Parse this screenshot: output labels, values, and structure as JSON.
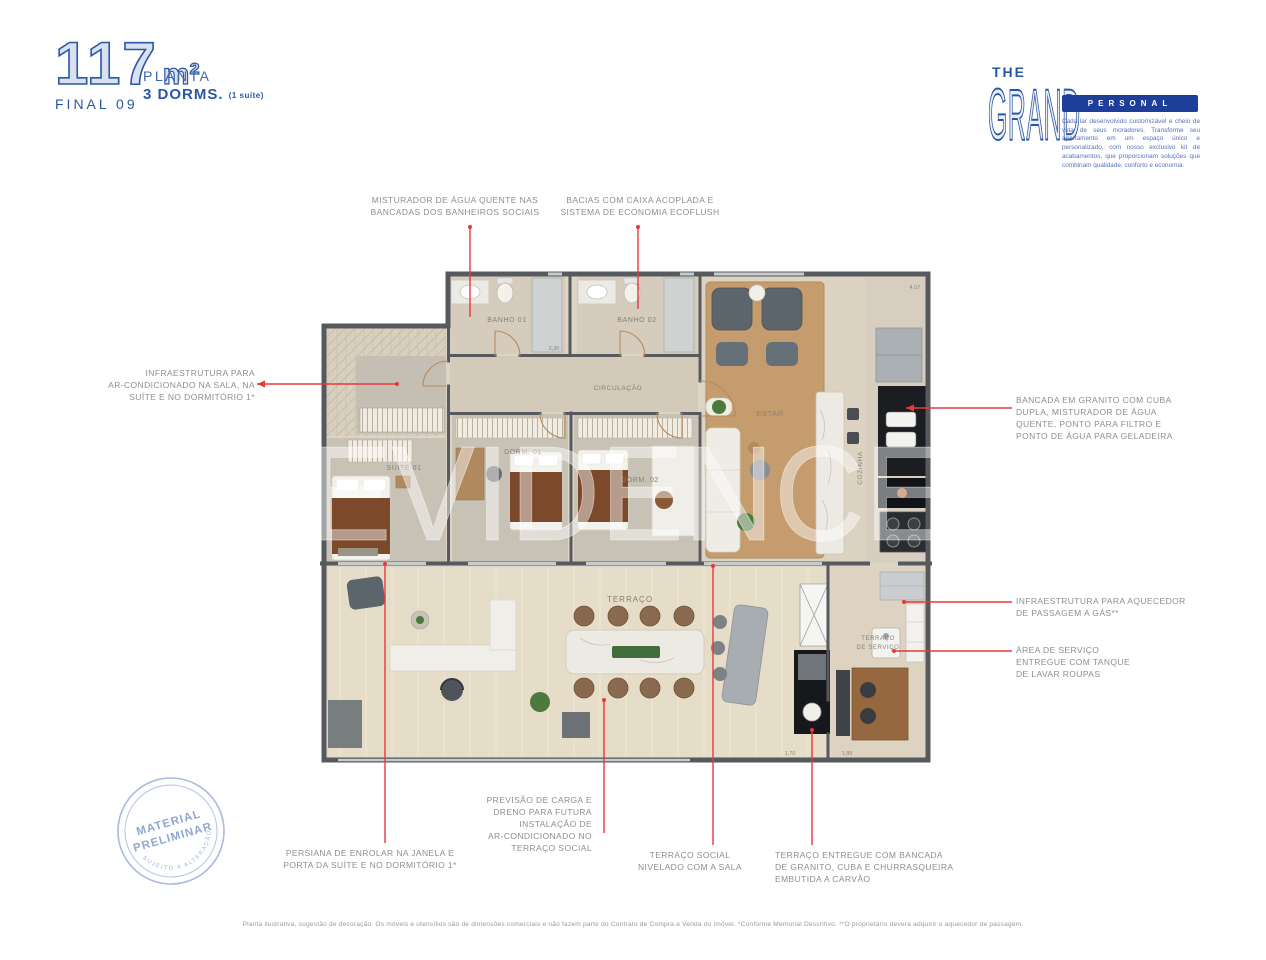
{
  "header": {
    "area_value": "117",
    "area_unit": "m²",
    "final": "FINAL 09",
    "planta": "PLANTA",
    "dorms": "3 DORMS.",
    "dorms_suffix": "(1 suíte)"
  },
  "brand": {
    "the": "THE",
    "grand": "GRAND",
    "personal": "PERSONAL",
    "tagline": "Cada lar desenvolvido customizável e cheio de vida de seus moradores. Transforme seu apartamento em um espaço único e personalizado, com nosso exclusivo kit de acabamentos, que proporcionam soluções que combinam qualidade, conforto e economia."
  },
  "floorplan": {
    "rooms": {
      "banho01": "BANHO 01",
      "banho02": "BANHO 02",
      "circulacao": "CIRCULAÇÃO",
      "suite": "SUÍTE 01",
      "dorm1": "DORM. 01",
      "dorm2": "DORM. 02",
      "estar": "ESTAR",
      "cozinha": "COZINHA",
      "terraco": "TERRAÇO",
      "terraco_servico_1": "TERRAÇO",
      "terraco_servico_2": "DE SERVIÇO"
    },
    "dimensions": [
      "2,30",
      "4,07",
      "1,70",
      "1,85"
    ]
  },
  "watermark": "EVIDENCE",
  "annotations": {
    "misturador": "MISTURADOR DE ÁGUA QUENTE NAS\nBANCADAS DOS BANHEIROS SOCIAIS",
    "bacias": "BACIAS COM CAIXA ACOPLADA E\nSISTEMA DE ECONOMIA ECOFLUSH",
    "infra_ar": "INFRAESTRUTURA PARA\nAR-CONDICIONADO NA SALA, NA\nSUÍTE E NO DORMITÓRIO 1*",
    "bancada": "BANCADA EM GRANITO COM CUBA\nDUPLA, MISTURADOR DE ÁGUA\nQUENTE, PONTO PARA FILTRO E\nPONTO DE ÁGUA PARA GELADEIRA",
    "aquecedor": "INFRAESTRUTURA PARA AQUECEDOR\nDE PASSAGEM A GÁS**",
    "area_servico": "ÁREA DE SERVIÇO\nENTREGUE COM TANQUE\nDE LAVAR ROUPAS",
    "persiana": "PERSIANA DE ENROLAR NA JANELA E\nPORTA DA SUÍTE E NO DORMITÓRIO 1*",
    "previsao": "PREVISÃO DE CARGA E\nDRENO PARA FUTURA\nINSTALAÇÃO DE\nAR-CONDICIONADO NO\nTERRAÇO SOCIAL",
    "terraco_social": "TERRAÇO SOCIAL\nNIVELADO COM A SALA",
    "terraco_entregue": "TERRAÇO ENTREGUE COM BANCADA\nDE GRANITO, CUBA E CHURRASQUEIRA\nEMBUTIDA A CARVÃO"
  },
  "stamp": {
    "line1": "MATERIAL",
    "line2": "PRELIMINAR",
    "curve": "SUJEITO A ALTERAÇÃO"
  },
  "disclaimer": "Planta ilustrativa, sugestão de decoração. Os móveis e utensílios são de dimensões comerciais e não fazem parte do Contrato de Compra e Venda do imóvel. *Conforme Memorial Descritivo. **O proprietário deverá adquirir o aquecedor de passagem.",
  "colors": {
    "brand_blue": "#2a57a5",
    "navy": "#1d3e99",
    "annotation_red": "#e8383b",
    "label_gray": "#8e8e8e",
    "wall_gray": "#565a5e"
  }
}
